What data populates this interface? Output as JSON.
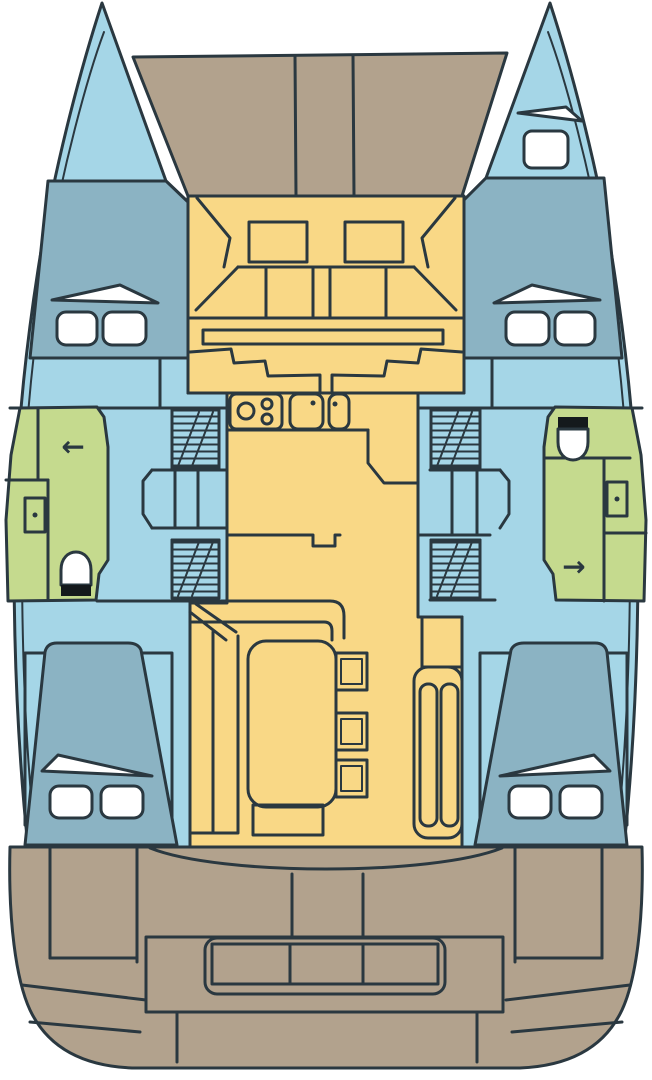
{
  "title": "catamaran-deck-plan",
  "colors": {
    "outline": "#2a3840",
    "background": "#ffffff",
    "hull": "#a5d6e7",
    "cabin": "#8bb3c3",
    "deck": "#b2a28d",
    "salon": "#f9d886",
    "bathroom": "#c5da8e",
    "fixture": "#ffffff",
    "toilet_base": "#14191c"
  },
  "glyphs": {
    "shower_arrow_left": "←",
    "shower_arrow_right": "→"
  }
}
